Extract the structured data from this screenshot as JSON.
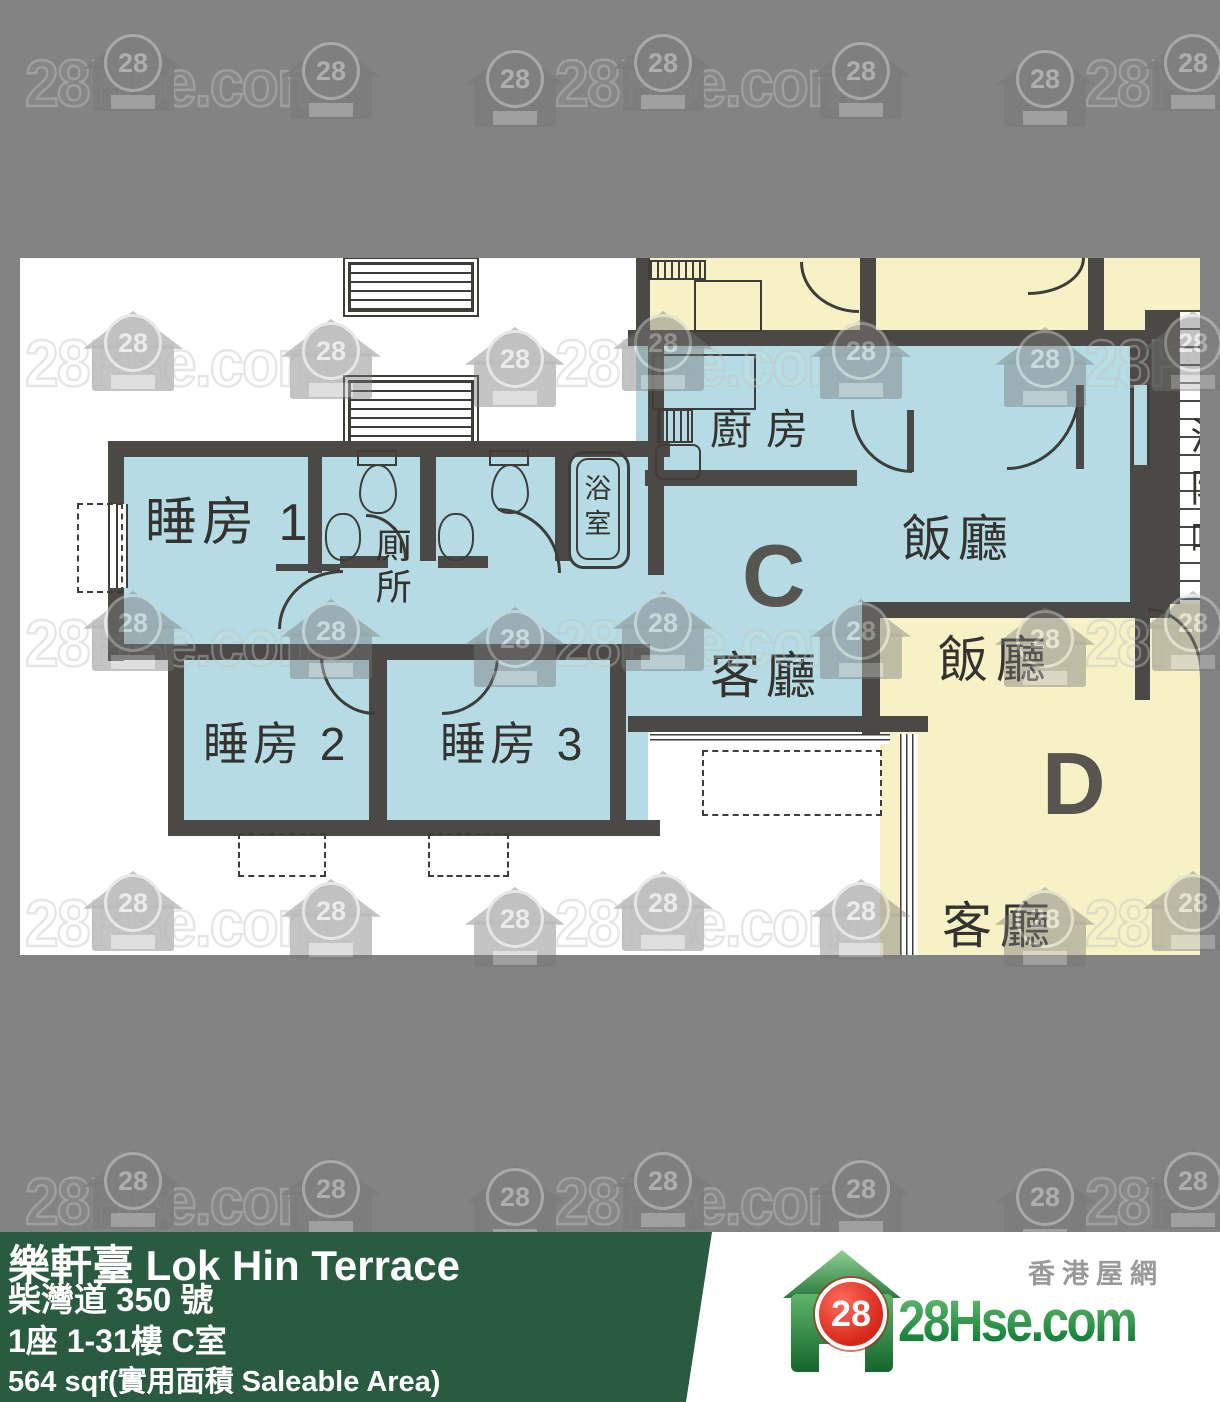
{
  "watermark": {
    "text": "28Hse.com",
    "badge": "28"
  },
  "plan": {
    "unit_c": {
      "label": "C",
      "bedroom1": "睡房 1",
      "bedroom2": "睡房 2",
      "bedroom3": "睡房 3",
      "toilet": "廁所",
      "bathroom": "浴室",
      "kitchen": "廚房",
      "dining": "飯廳",
      "living": "客廳"
    },
    "unit_d": {
      "label": "D",
      "dining": "飯廳",
      "living": "客廳"
    },
    "corridor": {
      "label": "消防喉"
    }
  },
  "info_bar": {
    "title": "樂軒臺 Lok Hin Terrace",
    "address": "柴灣道 350 號",
    "unit_floor": "1座 1-31樓 C室",
    "area": "564 sqf(實用面積 Saleable Area)",
    "bg_color": "#2a5a40"
  },
  "logo": {
    "site_name": "香港屋網",
    "brand": "28Hse.com",
    "badge": "28",
    "colors": {
      "green": "#1e7f3c",
      "red": "#d6281a"
    }
  }
}
